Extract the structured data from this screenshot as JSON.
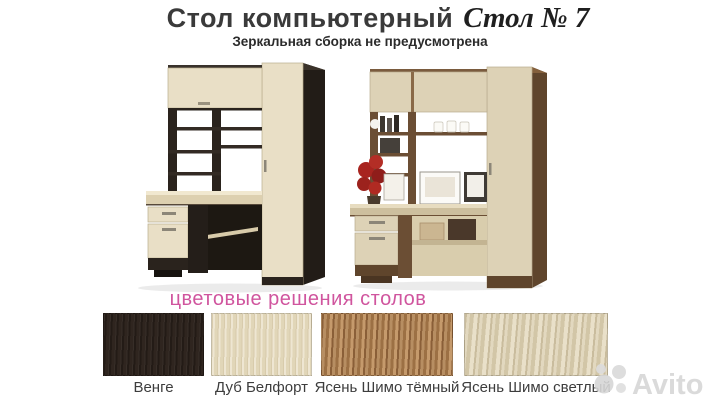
{
  "header": {
    "title_main": "Стол компьютерный",
    "title_accent": "Стол № 7",
    "subtitle": "Зеркальная сборка не предусмотрена"
  },
  "colors_section": {
    "heading": "цветовые решения столов",
    "heading_color": "#d0559e",
    "swatches": [
      {
        "label": "Венге",
        "hex": "#2b211b"
      },
      {
        "label": "Дуб Белфорт",
        "hex": "#e8dec3"
      },
      {
        "label": "Ясень Шимо тёмный",
        "hex": "#a87c52"
      },
      {
        "label": "Ясень Шимо светлый",
        "hex": "#d7cbae"
      }
    ]
  },
  "desk_photo_colors": {
    "left_frame": "#2a231d",
    "left_front": "#e9dfc6",
    "right_frame": "#6b4e34",
    "right_front": "#ddd2b6"
  },
  "watermark": {
    "brand": "Avito"
  }
}
